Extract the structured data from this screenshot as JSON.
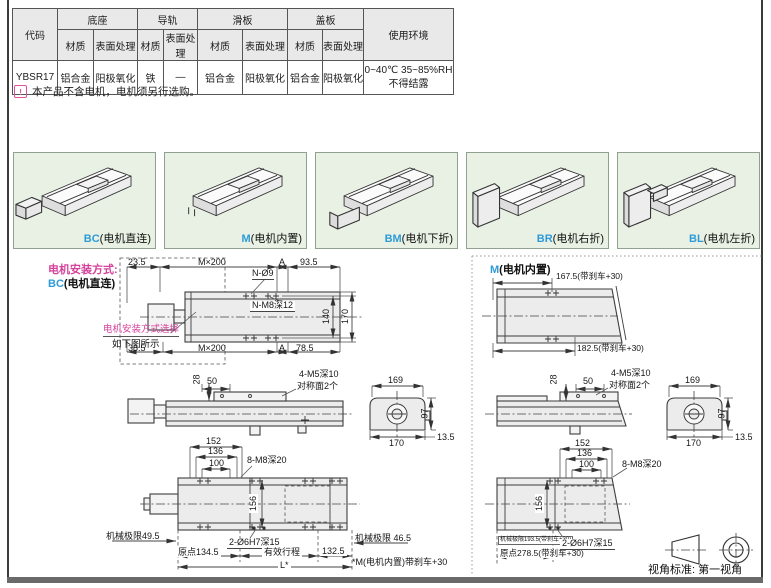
{
  "colors": {
    "magenta": "#d6429b",
    "blue": "#2e9bd8",
    "gallery_green": "#e8f1e3",
    "table_header_gray": "#e9e9e9",
    "drawing_fill": "#ececec"
  },
  "spec_table": {
    "code_header": "代码",
    "groups": [
      {
        "label": "底座"
      },
      {
        "label": "导轨"
      },
      {
        "label": "滑板"
      },
      {
        "label": "盖板"
      }
    ],
    "sub_material": "材质",
    "sub_surface": "表面处理",
    "env_header": "使用环境",
    "row": {
      "code": "YBSR17",
      "base_material": "铝合金",
      "base_surface": "阳极氧化",
      "rail_material": "铁",
      "rail_surface": "—",
      "slider_material": "铝合金",
      "slider_surface": "阳极氧化",
      "cover_material": "铝合金",
      "cover_surface": "阳极氧化",
      "env_line1": "0~40℃  35~85%RH",
      "env_line2": "不得结露"
    }
  },
  "note": {
    "icon": "!",
    "text": "本产品不含电机，电机须另行选购。"
  },
  "gallery": [
    {
      "code": "BC",
      "name": "(电机直连)"
    },
    {
      "code": "M",
      "name": "(电机内置)"
    },
    {
      "code": "BM",
      "name": "(电机下折)"
    },
    {
      "code": "BR",
      "name": "(电机右折)"
    },
    {
      "code": "BL",
      "name": "(电机左折)"
    }
  ],
  "bc": {
    "heading_label": "电机安装方式:",
    "heading_code": "BC",
    "heading_name": "(电机直连)",
    "selector_line1": "电机安装方式选择",
    "selector_line2": "如下图所示",
    "plan": {
      "d23_5": "23.5",
      "pitch_top": "M×200",
      "a_top": "A",
      "d93_5": "93.5",
      "holes_top": "N-Ø9",
      "holes_tap": "N-M8深12",
      "d140": "140",
      "d170": "170",
      "d38_5": "38.5",
      "pitch_bot": "M×200",
      "a_bot": "A",
      "d78_5": "78.5"
    },
    "side": {
      "d28": "28",
      "d50": "50",
      "tap1": "4-M5深10",
      "tap2": "对称面2个"
    },
    "section": {
      "d169": "169",
      "d97": "97",
      "d170": "170",
      "d13_5": "13.5"
    },
    "top": {
      "d152": "152",
      "d136": "136",
      "d100": "100",
      "tap": "8-M8深20",
      "d156": "156",
      "mech_left": "机械极限49.5",
      "origin": "原点134.5",
      "pin": "2-Ø6H7深15",
      "stroke": "有效行程",
      "d132_5": "132.5",
      "mech_right": "机械极限 46.5",
      "total": "L*",
      "footnote": "*M(电机内置)带刹车+30"
    }
  },
  "m": {
    "heading_code": "M",
    "heading_name": "(电机内置)",
    "plan": {
      "top_dim": "167.5(带刹车+30)",
      "bot_dim": "182.5(带刹车+30)"
    },
    "side": {
      "d28": "28",
      "d50": "50",
      "tap1": "4-M5深10",
      "tap2": "对称面2个"
    },
    "section": {
      "d169": "169",
      "d97": "97",
      "d170": "170",
      "d13_5": "13.5"
    },
    "top": {
      "d152": "152",
      "d136": "136",
      "d100": "100",
      "tap": "8-M8深20",
      "d156": "156",
      "mech": "机械极限193.5(带刹车+30)",
      "origin": "原点278.5(带刹车+30)",
      "pin": "2-Ø6H7深15"
    }
  },
  "projection": {
    "label": "视角标准:",
    "value": "第一视角"
  }
}
